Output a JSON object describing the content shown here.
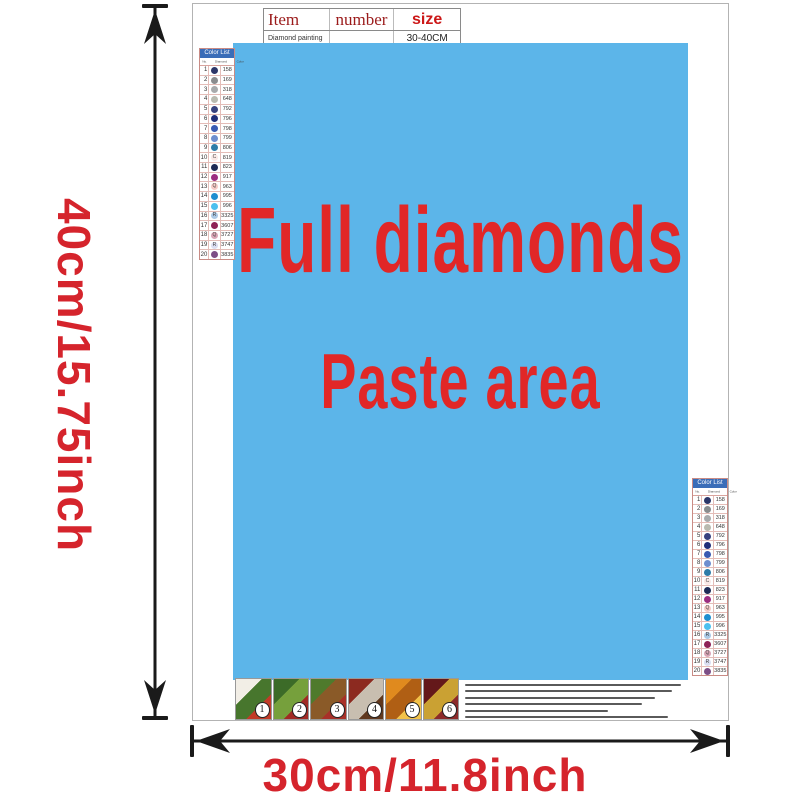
{
  "dimensions": {
    "height_label": "40cm/15.75inch",
    "width_label": "30cm/11.8inch",
    "label_color": "#d5242c",
    "arrow_color": "#1a1a1a"
  },
  "item_table": {
    "col_item": "Item",
    "col_number": "number",
    "col_size": "size",
    "product": "Diamond painting",
    "number_value": "",
    "size_value": "30-40CM"
  },
  "paste_area": {
    "line1": "Full diamonds",
    "line2": "Paste area",
    "background": "#5cb5e9",
    "text_color": "#e12727"
  },
  "color_list": {
    "title": "Color List",
    "title_bg": "#3a6db8",
    "columns": [
      "No.",
      "Diamond",
      "Color"
    ],
    "rows": [
      {
        "no": "1",
        "symbol": "",
        "code": "158",
        "color": "#2c3668"
      },
      {
        "no": "2",
        "symbol": "",
        "code": "169",
        "color": "#8a8c8e"
      },
      {
        "no": "3",
        "symbol": "",
        "code": "318",
        "color": "#a8aaac"
      },
      {
        "no": "4",
        "symbol": "",
        "code": "648",
        "color": "#b9bab0"
      },
      {
        "no": "5",
        "symbol": "",
        "code": "792",
        "color": "#38427f"
      },
      {
        "no": "6",
        "symbol": "",
        "code": "796",
        "color": "#1f2d78"
      },
      {
        "no": "7",
        "symbol": "",
        "code": "798",
        "color": "#3a5ab2"
      },
      {
        "no": "8",
        "symbol": "",
        "code": "799",
        "color": "#6e8ecf"
      },
      {
        "no": "9",
        "symbol": "",
        "code": "806",
        "color": "#2e7ca8"
      },
      {
        "no": "10",
        "symbol": "C",
        "code": "819",
        "color": "#f9e8e6"
      },
      {
        "no": "11",
        "symbol": "",
        "code": "823",
        "color": "#1d2a55"
      },
      {
        "no": "12",
        "symbol": "",
        "code": "917",
        "color": "#9c2d80"
      },
      {
        "no": "13",
        "symbol": "Q",
        "code": "963",
        "color": "#f6cbc7"
      },
      {
        "no": "14",
        "symbol": "",
        "code": "995",
        "color": "#1e8ed0"
      },
      {
        "no": "15",
        "symbol": "",
        "code": "996",
        "color": "#4cc0ee"
      },
      {
        "no": "16",
        "symbol": "R",
        "code": "3325",
        "color": "#abc9e6"
      },
      {
        "no": "17",
        "symbol": "",
        "code": "3607",
        "color": "#8e2156"
      },
      {
        "no": "18",
        "symbol": "Q",
        "code": "3727",
        "color": "#d9a5b6"
      },
      {
        "no": "19",
        "symbol": "R",
        "code": "3747",
        "color": "#dadef2"
      },
      {
        "no": "20",
        "symbol": "",
        "code": "3835",
        "color": "#7c4e86"
      }
    ]
  },
  "steps": [
    {
      "number": "1",
      "colors": [
        "#f2eee6",
        "#47762d",
        "#c23b28"
      ]
    },
    {
      "number": "2",
      "colors": [
        "#3c6b28",
        "#76a03c",
        "#a12a24"
      ]
    },
    {
      "number": "3",
      "colors": [
        "#4f7a2c",
        "#8a5a28",
        "#a83028"
      ]
    },
    {
      "number": "4",
      "colors": [
        "#8c2a20",
        "#c8beb0",
        "#60381e"
      ]
    },
    {
      "number": "5",
      "colors": [
        "#e08a1e",
        "#b05f14",
        "#f2c249"
      ]
    },
    {
      "number": "6",
      "colors": [
        "#64181a",
        "#caa133",
        "#8c2a2a"
      ]
    }
  ],
  "instructions": {
    "line_color": "#5a5a5a",
    "line_widths_pct": [
      100,
      96,
      88,
      82,
      66,
      94
    ]
  }
}
